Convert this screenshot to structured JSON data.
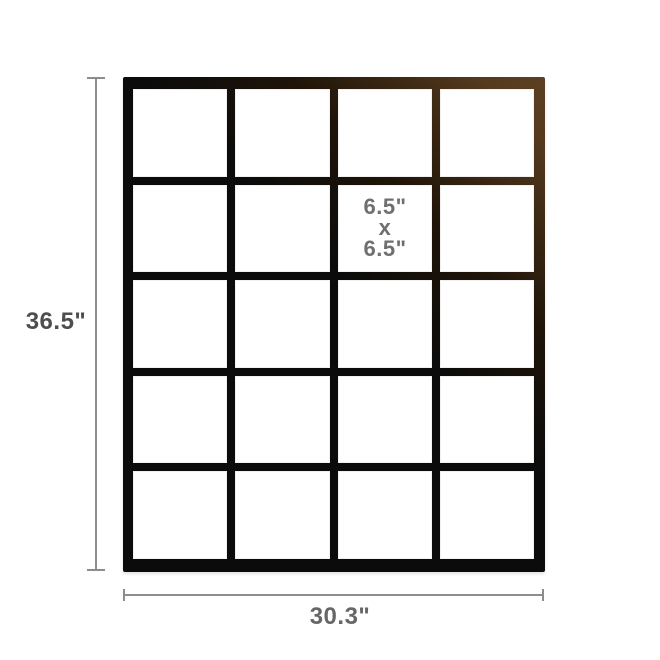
{
  "diagram": {
    "type": "product-dimension-diagram",
    "product": "black metal grid wall frame",
    "height_label": "36.5\"",
    "width_label": "30.3\"",
    "cell_label": [
      "6.5\"",
      "x",
      "6.5\""
    ],
    "grid": {
      "columns": 4,
      "rows": 5,
      "openings": 20
    },
    "colors": {
      "background": "#ffffff",
      "frame_black": "#0b0b0b",
      "frame_highlight_brown": "#553a1e",
      "cell_fill": "#ffffff",
      "dimension_line": "#8d8d8d",
      "dimension_text_dark": "#4e4e4e",
      "dimension_text": "#666666",
      "cell_label_text": "#6f6f6f"
    }
  }
}
